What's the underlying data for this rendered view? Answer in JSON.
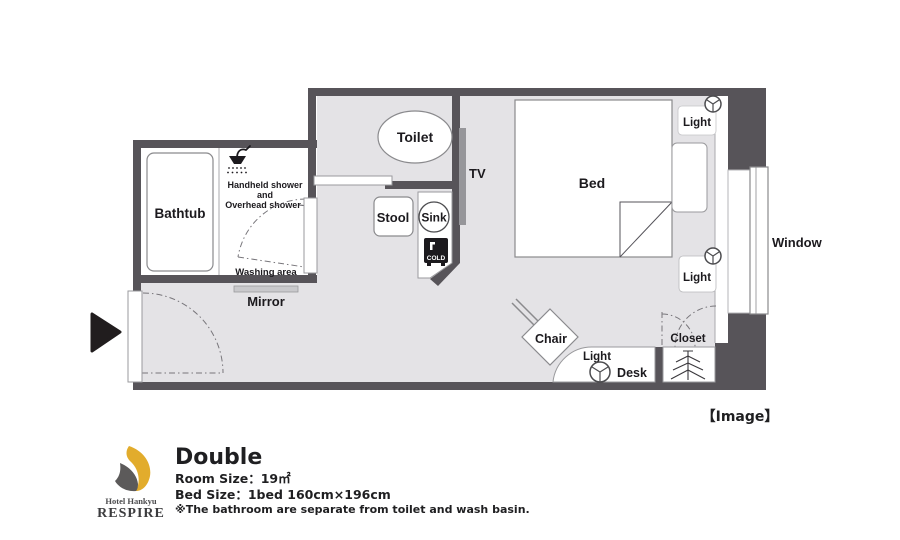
{
  "plan": {
    "bathtub": "Bathtub",
    "shower_line1": "Handheld shower",
    "shower_line2": "and",
    "shower_line3": "Overhead shower",
    "washing_area": "Washing area",
    "mirror": "Mirror",
    "toilet": "Toilet",
    "stool": "Stool",
    "sink": "Sink",
    "cold": "COLD",
    "tv": "TV",
    "bed": "Bed",
    "light": "Light",
    "window": "Window",
    "chair": "Chair",
    "desk": "Desk",
    "closet": "Closet",
    "caption": "【Image】"
  },
  "footer": {
    "logo_hotel": "Hotel Hankyu",
    "logo_brand": "RESPIRE",
    "room_type": "Double",
    "room_size": "Room Size：19㎡",
    "bed_size": "Bed Size：1bed 160cm×196cm",
    "note": "※The bathroom are separate from toilet and wash basin."
  },
  "colors": {
    "wall": "#575459",
    "floor": "#e4e3e6",
    "ink": "#1c1a1e",
    "brand-yellow": "#e2ac2c",
    "brand-gray": "#5c5a5a"
  }
}
